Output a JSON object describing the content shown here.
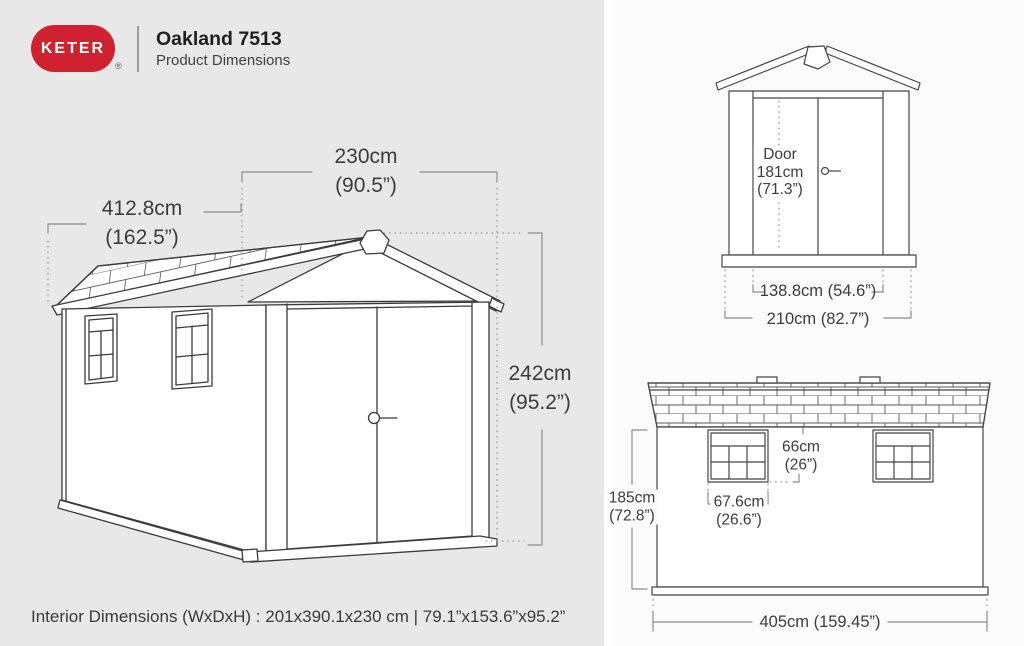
{
  "header": {
    "brand": "KETER",
    "registered_mark": "®",
    "title": "Oakland 7513",
    "subtitle": "Product Dimensions"
  },
  "colors": {
    "brand_red": "#cf2130",
    "left_panel_gray": "#e8e8e8",
    "right_panel_gray": "#fbfbfb",
    "line_dark": "#3b3b3b",
    "dimension_gray": "#8c8c8c"
  },
  "main_drawing": {
    "width": {
      "cm": "230cm",
      "in": "(90.5”)"
    },
    "depth": {
      "cm": "412.8cm",
      "in": "(162.5”)"
    },
    "height": {
      "cm": "242cm",
      "in": "(95.2”)"
    }
  },
  "front_view": {
    "door": {
      "label": "Door",
      "cm": "181cm",
      "in": "(71.3”)"
    },
    "inner_width": "138.8cm (54.6”)",
    "outer_width": "210cm (82.7”)"
  },
  "side_view": {
    "window_height": {
      "cm": "66cm",
      "in": "(26”)"
    },
    "window_width": {
      "cm": "67.6cm",
      "in": "(26.6”)"
    },
    "wall_height": {
      "cm": "185cm",
      "in": "(72.8”)"
    },
    "total_width": "405cm (159.45”)"
  },
  "footer": {
    "interior_note": "Interior Dimensions (WxDxH) : 201x390.1x230 cm | 79.1”x153.6”x95.2”"
  }
}
